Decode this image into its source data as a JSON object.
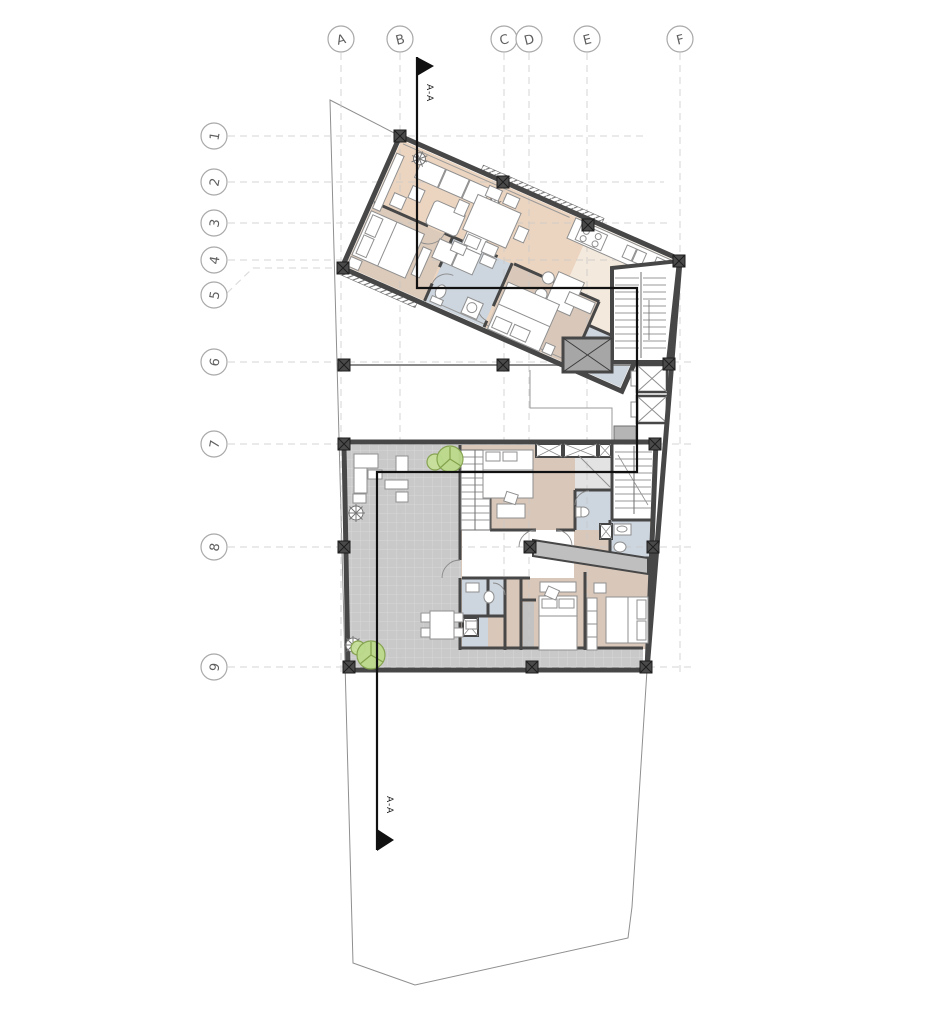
{
  "drawing": {
    "type": "architectural-floor-plan",
    "section": {
      "label": "A-A"
    },
    "grid": {
      "columns": [
        {
          "label": "A"
        },
        {
          "label": "B"
        },
        {
          "label": "C"
        },
        {
          "label": "D"
        },
        {
          "label": "E"
        },
        {
          "label": "F"
        }
      ],
      "rows": [
        {
          "label": "1"
        },
        {
          "label": "2"
        },
        {
          "label": "3"
        },
        {
          "label": "4"
        },
        {
          "label": "5"
        },
        {
          "label": "6"
        },
        {
          "label": "7"
        },
        {
          "label": "8"
        },
        {
          "label": "9"
        }
      ]
    },
    "colors": {
      "wall": "#474747",
      "living_floor": "#ecd5c0",
      "kitchen_floor": "#f3e9dc",
      "bedroom_floor": "#dccaba",
      "bathroom_floor": "#cdd5de",
      "terrace_tile": "#c9c9c9",
      "core_gray": "#a6a6a6",
      "tree_green": "#bcda8b",
      "grid_line": "#c8c8c8",
      "section_line": "#111111"
    }
  }
}
